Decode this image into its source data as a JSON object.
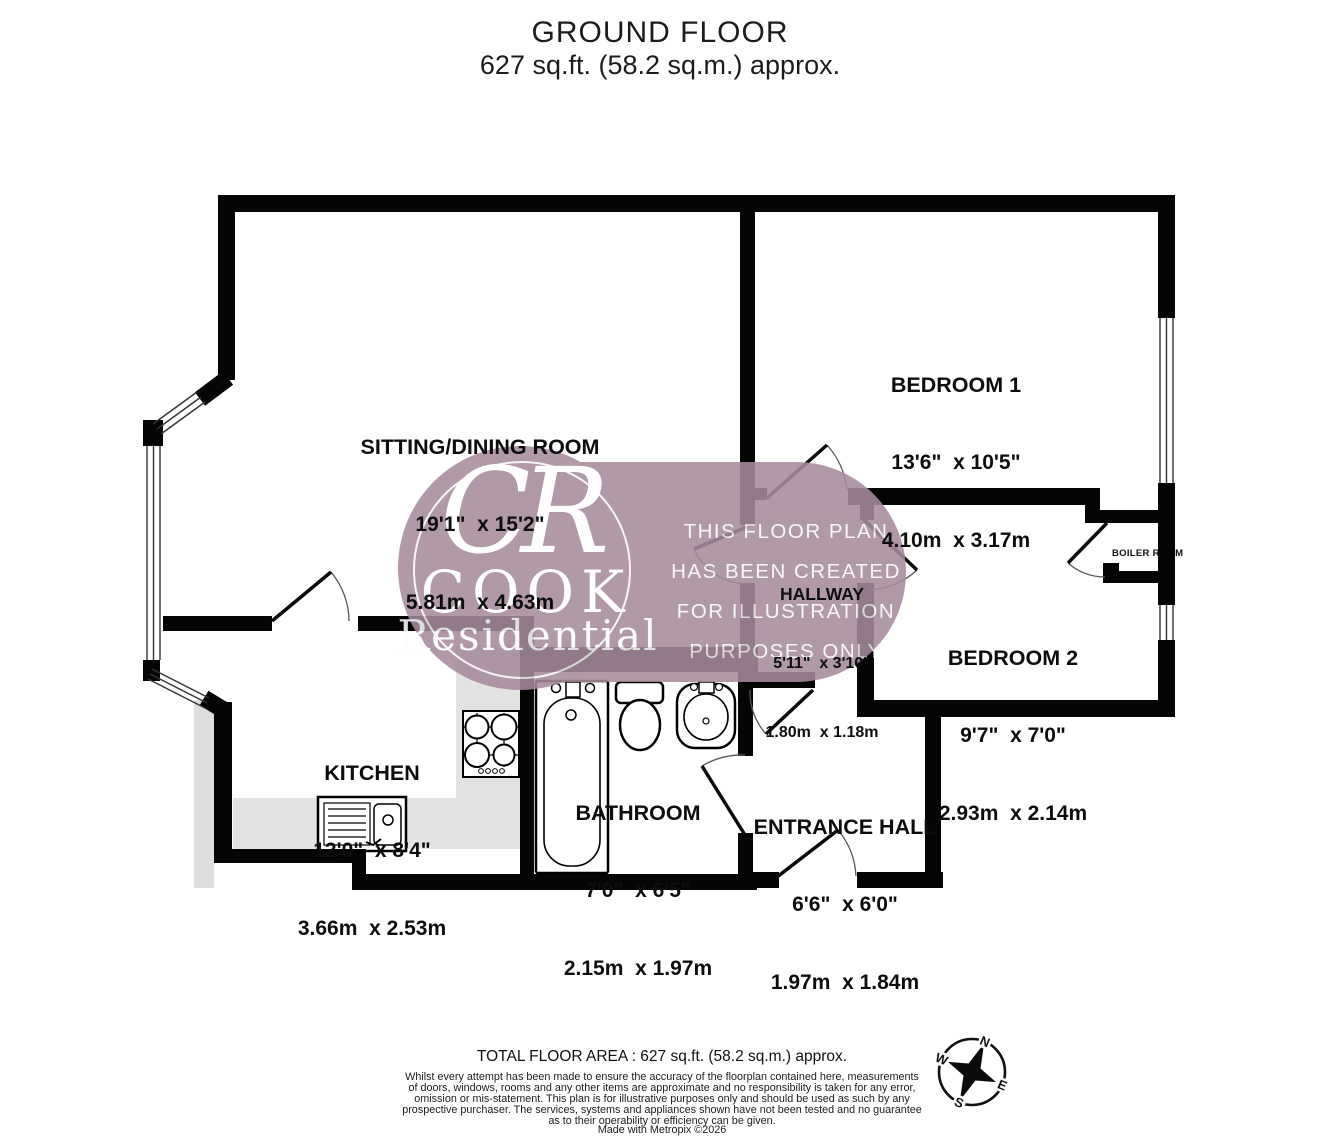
{
  "title": {
    "line1": "GROUND FLOOR",
    "line2": "627 sq.ft. (58.2 sq.m.) approx."
  },
  "rooms": {
    "sitting": {
      "name": "SITTING/DINING ROOM",
      "imperial": "19'1\"  x 15'2\"",
      "metric": "5.81m  x 4.63m"
    },
    "bedroom1": {
      "name": "BEDROOM 1",
      "imperial": "13'6\"  x 10'5\"",
      "metric": "4.10m  x 3.17m"
    },
    "bedroom2": {
      "name": "BEDROOM 2",
      "imperial": "9'7\"  x 7'0\"",
      "metric": "2.93m  x 2.14m"
    },
    "hallway": {
      "name": "HALLWAY",
      "imperial": "5'11\"  x 3'10\"",
      "metric": "1.80m  x 1.18m"
    },
    "kitchen": {
      "name": "KITCHEN",
      "imperial": "12'0\"  x 8'4\"",
      "metric": "3.66m  x 2.53m"
    },
    "bathroom": {
      "name": "BATHROOM",
      "imperial": "7'0\"  x 6'5\"",
      "metric": "2.15m  x 1.97m"
    },
    "entrance": {
      "name": "ENTRANCE HALL",
      "imperial": "6'6\"  x 6'0\"",
      "metric": "1.97m  x 1.84m"
    },
    "boiler": {
      "name": "BOILER ROOM"
    }
  },
  "watermark": {
    "monogram": "CR",
    "brand": "COOK",
    "sub": "Residential",
    "notice_line1": "THIS FLOOR PLAN",
    "notice_line2": "HAS BEEN CREATED",
    "notice_line3": "FOR ILLUSTRATION",
    "notice_line4": "PURPOSES ONLY",
    "color": "#a78b9d"
  },
  "compass": {
    "n": "N",
    "e": "E",
    "s": "S",
    "w": "W"
  },
  "footer": {
    "total": "TOTAL FLOOR AREA : 627 sq.ft. (58.2 sq.m.) approx.",
    "disclaimer_line1": "Whilst every attempt has been made to ensure the accuracy of the floorplan contained here, measurements",
    "disclaimer_line2": "of doors, windows, rooms and any other items are approximate and no responsibility is taken for any error,",
    "disclaimer_line3": "omission or mis-statement. This plan is for illustrative purposes only and should be used as such by any",
    "disclaimer_line4": "prospective purchaser. The services, systems and appliances shown have not been tested and no guarantee",
    "disclaimer_line5": "as to their operability or efficiency can be given.",
    "made_with": "Made with Metropix ©2026"
  }
}
